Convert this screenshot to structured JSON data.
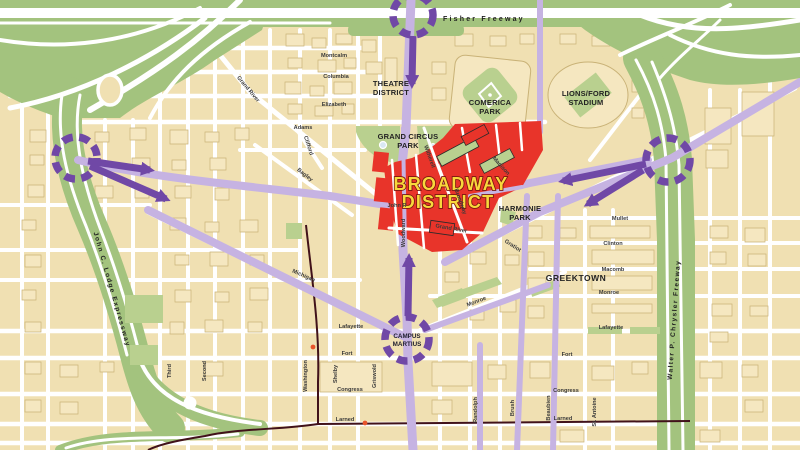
{
  "map": {
    "colors": {
      "land": "#f0e0b2",
      "street": "#ffffff",
      "building": "#f5e7c0",
      "building_outline": "#c9b277",
      "freeway_green": "#a3c37e",
      "park_green": "#b9d08f",
      "route_light": "#c6b3e2",
      "route_dark": "#7048a6",
      "district_red": "#e8342a",
      "district_text_fill": "#f8d83c",
      "district_text_outline": "#7a150e",
      "label": "#3a3a3a",
      "people_mover": "#41121a",
      "station": "#e8542a"
    },
    "freeways": {
      "fisher": "Fisher Freeway",
      "lodge": "John C. Lodge Expressway",
      "chrysler": "Walter P. Chrysler Freeway"
    },
    "regions": {
      "broadway_line1": "BROADWAY",
      "broadway_line2": "DISTRICT",
      "theatre_line1": "THEATRE",
      "theatre_line2": "DISTRICT",
      "comerica_line1": "COMERICA",
      "comerica_line2": "PARK",
      "stadium_line1": "LIONS/FORD",
      "stadium_line2": "STADIUM",
      "grand_circus_line1": "GRAND CIRCUS",
      "grand_circus_line2": "PARK",
      "harmonie_line1": "HARMONIE",
      "harmonie_line2": "PARK",
      "greektown": "GREEKTOWN",
      "campus_line1": "CAMPUS",
      "campus_line2": "MARTIUS"
    },
    "streets": {
      "montcalm": "Montcalm",
      "columbia": "Columbia",
      "elizabeth": "Elizabeth",
      "adams": "Adams",
      "grand_river_nw": "Grand River",
      "clifford": "Clifford",
      "bagley": "Bagley",
      "witherell": "Witherell",
      "madison": "Madison",
      "john_r": "John R",
      "woodward": "Woodward",
      "broadway": "Broadway",
      "grand_river_s": "Grand River",
      "gratiot": "Gratiot",
      "mullet": "Mullet",
      "clinton": "Clinton",
      "macomb": "Macomb",
      "monroe_e": "Monroe",
      "lafayette_e": "Lafayette",
      "fort_e": "Fort",
      "congress_e": "Congress",
      "larned_e": "Larned",
      "monroe_ne": "Monroe",
      "randolph": "Randolph",
      "brush": "Brush",
      "beaubien": "Beaubien",
      "st_antoine": "St. Antoine",
      "michigan": "Michigan",
      "washington": "Washington",
      "shelby": "Shelby",
      "griswold": "Griswold",
      "lafayette_w": "Lafayette",
      "fort_w": "Fort",
      "congress_w": "Congress",
      "larned_w": "Larned",
      "third": "Third",
      "second": "Second"
    }
  }
}
